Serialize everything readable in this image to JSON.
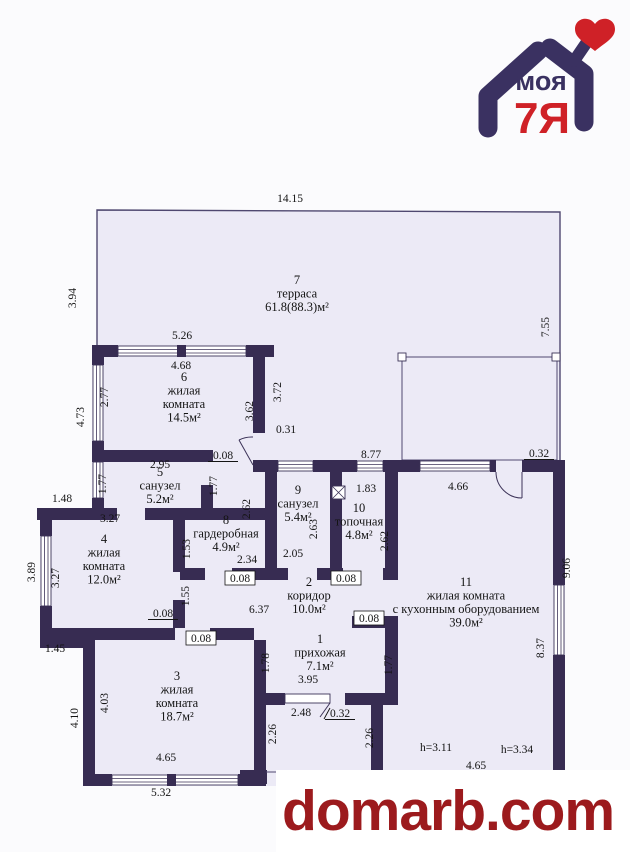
{
  "logo": {
    "text_top": "моя",
    "text_bottom": "7Я",
    "purple": "#3a3161",
    "red": "#cf2127"
  },
  "watermark": {
    "text": "domarb.com",
    "color": "#9c1a1d"
  },
  "plan": {
    "wall_color": "#372c52",
    "floor_color": "#eceaf6",
    "rooms": [
      {
        "num": "7",
        "name_lines": [
          "терраса"
        ],
        "area": "61.8(88.3)м²",
        "x": 297,
        "y": 284
      },
      {
        "num": "6",
        "name_lines": [
          "жилая",
          "комната"
        ],
        "area": "14.5м²",
        "x": 184,
        "y": 381
      },
      {
        "num": "5",
        "name_lines": [
          "санузел"
        ],
        "area": "5.2м²",
        "x": 160,
        "y": 476
      },
      {
        "num": "9",
        "name_lines": [
          "санузел"
        ],
        "area": "5.4м²",
        "x": 298,
        "y": 494
      },
      {
        "num": "10",
        "name_lines": [
          "топочная"
        ],
        "area": "4.8м²",
        "x": 359,
        "y": 512
      },
      {
        "num": "8",
        "name_lines": [
          "гардеробная"
        ],
        "area": "4.9м²",
        "x": 226,
        "y": 524
      },
      {
        "num": "4",
        "name_lines": [
          "жилая",
          "комната"
        ],
        "area": "12.0м²",
        "x": 104,
        "y": 543
      },
      {
        "num": "2",
        "name_lines": [
          "коридор"
        ],
        "area": "10.0м²",
        "x": 309,
        "y": 586
      },
      {
        "num": "11",
        "name_lines": [
          "жилая комната",
          "с кухонным оборудованием"
        ],
        "area": "39.0м²",
        "x": 466,
        "y": 586
      },
      {
        "num": "1",
        "name_lines": [
          "прихожая"
        ],
        "area": "7.1м²",
        "x": 320,
        "y": 643
      },
      {
        "num": "3",
        "name_lines": [
          "жилая",
          "комната"
        ],
        "area": "18.7м²",
        "x": 177,
        "y": 680
      }
    ],
    "dims": [
      {
        "t": "14.15",
        "x": 290,
        "y": 202
      },
      {
        "t": "3.94",
        "x": 76,
        "y": 298,
        "rot": 1
      },
      {
        "t": "7.55",
        "x": 549,
        "y": 327,
        "rot": 1
      },
      {
        "t": "5.26",
        "x": 182,
        "y": 339
      },
      {
        "t": "4.68",
        "x": 181,
        "y": 369
      },
      {
        "t": "2.77",
        "x": 108,
        "y": 397,
        "rot": 1
      },
      {
        "t": "4.73",
        "x": 84,
        "y": 417,
        "rot": 1
      },
      {
        "t": "3.62",
        "x": 253,
        "y": 411,
        "rot": 1
      },
      {
        "t": "3.72",
        "x": 281,
        "y": 392,
        "rot": 1
      },
      {
        "t": "0.31",
        "x": 286,
        "y": 433
      },
      {
        "t": "2.95",
        "x": 160,
        "y": 468
      },
      {
        "t": "0.08",
        "x": 223,
        "y": 459,
        "style": "u"
      },
      {
        "t": "8.77",
        "x": 371,
        "y": 458
      },
      {
        "t": "1.83",
        "x": 366,
        "y": 492
      },
      {
        "t": "4.66",
        "x": 458,
        "y": 490
      },
      {
        "t": "0.32",
        "x": 539,
        "y": 457,
        "style": "u"
      },
      {
        "t": "1.77",
        "x": 106,
        "y": 484,
        "rot": 1
      },
      {
        "t": "1.77",
        "x": 217,
        "y": 486,
        "rot": 1
      },
      {
        "t": "1.48",
        "x": 62,
        "y": 502
      },
      {
        "t": "3.27",
        "x": 110,
        "y": 522
      },
      {
        "t": "2.62",
        "x": 250,
        "y": 509,
        "rot": 1
      },
      {
        "t": "2.63",
        "x": 317,
        "y": 529,
        "rot": 1
      },
      {
        "t": "2.62",
        "x": 388,
        "y": 541,
        "rot": 1
      },
      {
        "t": "2.05",
        "x": 293,
        "y": 557
      },
      {
        "t": "3.89",
        "x": 35,
        "y": 572,
        "rot": 1
      },
      {
        "t": "3.27",
        "x": 59,
        "y": 578,
        "rot": 1
      },
      {
        "t": "1.53",
        "x": 190,
        "y": 549,
        "rot": 1
      },
      {
        "t": "1.55",
        "x": 189,
        "y": 596,
        "rot": 1
      },
      {
        "t": "2.34",
        "x": 247,
        "y": 563
      },
      {
        "t": "0.08",
        "x": 240,
        "y": 582,
        "style": "b"
      },
      {
        "t": "0.08",
        "x": 346,
        "y": 582,
        "style": "b"
      },
      {
        "t": "9.06",
        "x": 570,
        "y": 568,
        "rot": 1
      },
      {
        "t": "8.37",
        "x": 544,
        "y": 648,
        "rot": 1
      },
      {
        "t": "1.45",
        "x": 55,
        "y": 652
      },
      {
        "t": "0.08",
        "x": 163,
        "y": 617,
        "style": "u"
      },
      {
        "t": "0.08",
        "x": 201,
        "y": 642,
        "style": "b"
      },
      {
        "t": "6.37",
        "x": 259,
        "y": 613
      },
      {
        "t": "0.08",
        "x": 369,
        "y": 622,
        "style": "b"
      },
      {
        "t": "1.78",
        "x": 269,
        "y": 663,
        "rot": 1
      },
      {
        "t": "1.77",
        "x": 392,
        "y": 665,
        "rot": 1
      },
      {
        "t": "3.95",
        "x": 308,
        "y": 683
      },
      {
        "t": "2.48",
        "x": 301,
        "y": 716
      },
      {
        "t": "0.32",
        "x": 340,
        "y": 717,
        "style": "s"
      },
      {
        "t": "4.03",
        "x": 108,
        "y": 703,
        "rot": 1
      },
      {
        "t": "4.10",
        "x": 78,
        "y": 718,
        "rot": 1
      },
      {
        "t": "2.26",
        "x": 276,
        "y": 734,
        "rot": 1
      },
      {
        "t": "2.26",
        "x": 373,
        "y": 738,
        "rot": 1
      },
      {
        "t": "h=3.11",
        "x": 436,
        "y": 751
      },
      {
        "t": "h=3.34",
        "x": 517,
        "y": 753
      },
      {
        "t": "4.65",
        "x": 476,
        "y": 769
      },
      {
        "t": "4.65",
        "x": 166,
        "y": 761
      },
      {
        "t": "5.32",
        "x": 161,
        "y": 796
      }
    ],
    "symbols": [
      {
        "name": "boiler-icon",
        "x": 332,
        "y": 486
      }
    ]
  }
}
